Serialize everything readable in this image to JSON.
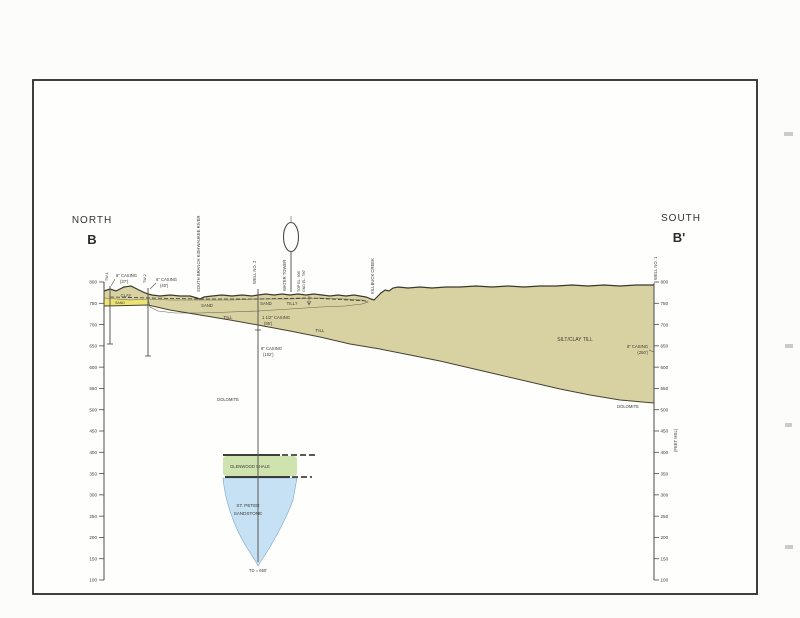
{
  "header": {
    "north_label": "NORTH",
    "north_point": "B",
    "south_label": "SOUTH",
    "south_point": "B'"
  },
  "axis": {
    "ticks": [
      800,
      750,
      700,
      650,
      600,
      550,
      500,
      450,
      400,
      350,
      300,
      250,
      200,
      150,
      100
    ],
    "unit_note": "(FEET MSL)"
  },
  "features": {
    "river": "SOUTH BRANCH KISHWAUKEE RIVER",
    "creek": "KILLBUCK CREEK",
    "water_tower": "WATER TOWER",
    "tower_top": "TOP EL. 908'",
    "tower_base": "GND EL. 790'"
  },
  "wells": {
    "w1_id": "TW-1",
    "w1_casing": "6\" CASING",
    "w1_depth": "(37')",
    "w2_id": "TW-2",
    "w2_casing": "6\" CASING",
    "w2_depth": "(40')",
    "mun_id": "WELL NO. 2",
    "mun_casing1": "1 1/2\" CASING",
    "mun_casing1_depth": "(95')",
    "mun_casing2": "8\" CASING",
    "mun_casing2_depth": "(102')",
    "mun_td": "TD = 650'",
    "s_id": "WELL NO. 1",
    "s_casing": "8\" CASING",
    "s_depth": "(250')"
  },
  "strata": {
    "clay": "CLAY",
    "sand_a": "SAND",
    "sand_b": "SAND",
    "sand_c": "SAND",
    "till_q": "TILL?",
    "till_a": "TILL",
    "till_b": "TILL",
    "silt_clay_till": "SILT/CLAY TILL",
    "dolomite_a": "DOLOMITE",
    "dolomite_b": "DOLOMITE",
    "shale": "GLENWOOD SHALE",
    "sandstone1": "ST. PETER",
    "sandstone2": "SANDSTONE"
  },
  "colors": {
    "till": "#d8d1a2",
    "sand": "#ede375",
    "shale": "#cfe3ae",
    "sandstone": "#c7e1f4",
    "line": "#3c382c"
  }
}
